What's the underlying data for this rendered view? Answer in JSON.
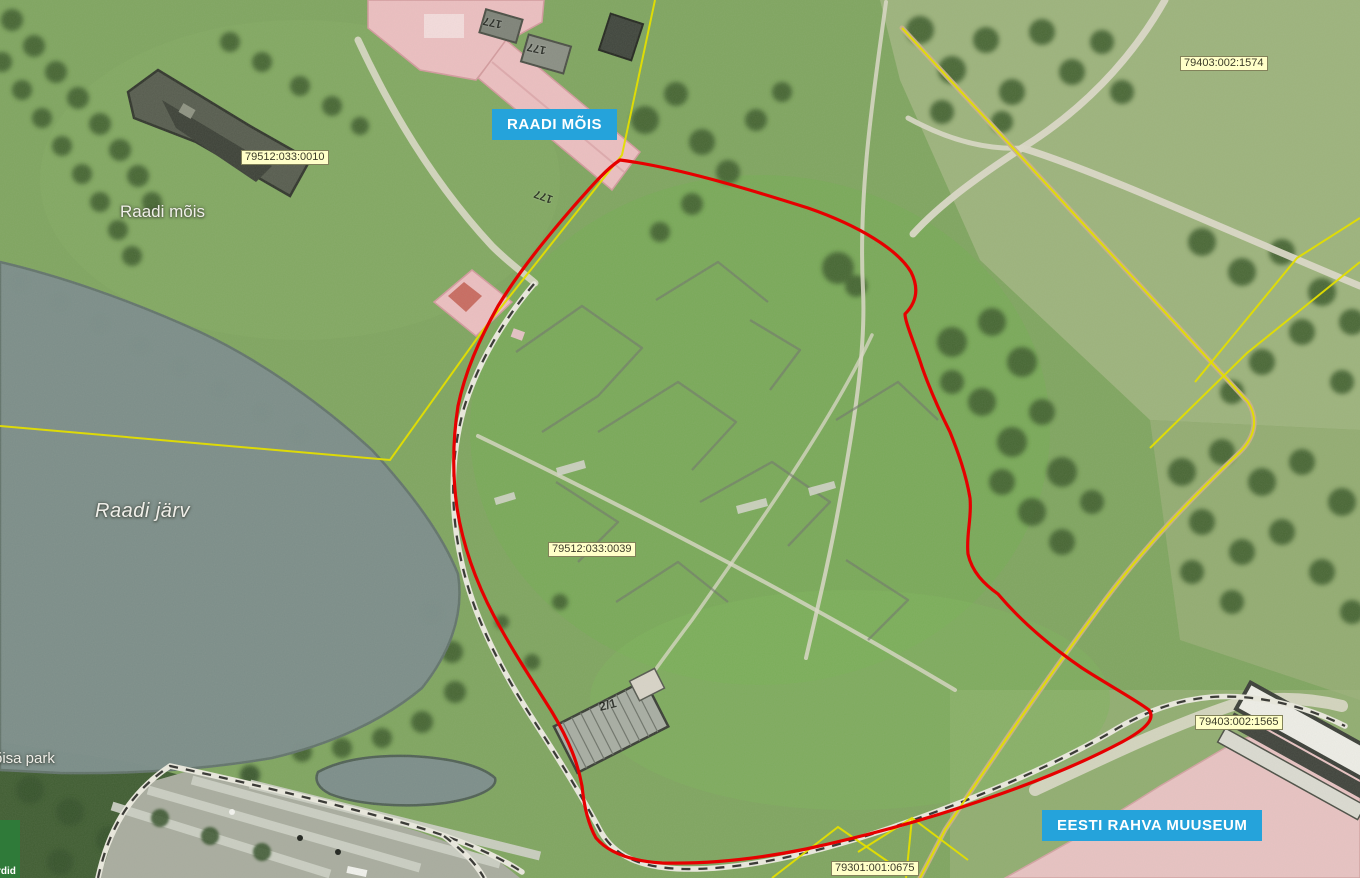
{
  "badges": {
    "raadi_mois": "RAADI MÕIS",
    "eesti_rahva_muuseum": "EESTI RAHVA MUUSEUM"
  },
  "cadastral_codes": {
    "c0010": "79512:033:0010",
    "c1574": "79403:002:1574",
    "c0039": "79512:033:0039",
    "c1565": "79403:002:1565",
    "c0675": "79301:001:0675"
  },
  "toponyms": {
    "manor": "Raadi mõis",
    "lake": "Raadi järv",
    "park_partial": "õisa park",
    "green_label_partial": "rdid"
  },
  "building_numbers": {
    "n177_a": "177",
    "n177_b": "177",
    "n177_wing": "177",
    "n2_1": "2/1"
  },
  "colors": {
    "badge_blue": "#25a3db",
    "cadastral_bg": "#ffffc8",
    "cadastral_border": "#82825a",
    "cadastral_text": "#3c3c28",
    "selection_red": "#e60000",
    "boundary_yellow": "#e3de00",
    "road_tan": "#cbb089",
    "lake_gray": "#7c8d8a"
  }
}
